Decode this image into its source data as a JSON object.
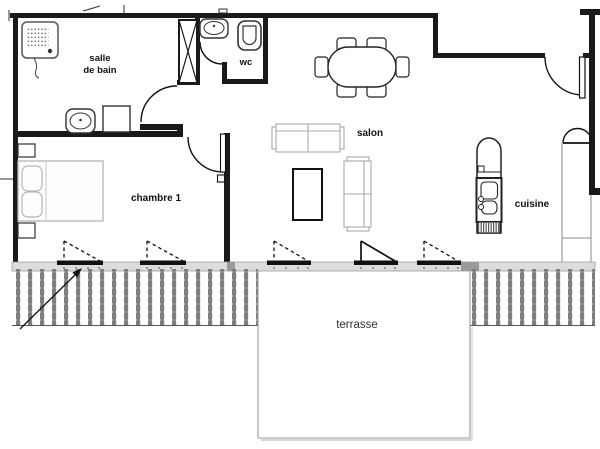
{
  "title": "apartment floor plan",
  "rooms": {
    "bathroom": {
      "line1": "salle",
      "line2": "de bain"
    },
    "wc": {
      "label": "wc"
    },
    "living": {
      "label": "salon"
    },
    "bedroom": {
      "label": "chambre 1"
    },
    "kitchen": {
      "label": "cuisine"
    },
    "terrace": {
      "label": "terrasse"
    }
  },
  "fixtures": [
    "shower",
    "bathroom-sink",
    "washing-machine",
    "duct-column",
    "wc-hand-basin",
    "toilet",
    "bed",
    "nightstand",
    "dining-table",
    "dining-chair",
    "sofa",
    "coffee-table",
    "fridge",
    "kitchen-sink",
    "stove",
    "entrance-door",
    "interior-door",
    "window",
    "terrace-door",
    "terrace-railing",
    "entrance-arrow"
  ],
  "colors": {
    "wall": "#1a1a1a",
    "facade_band": "#dcdcdc",
    "facade_pier": "#9a9a9a",
    "window_sill": "#111111",
    "railing_bar": "#7d7d7d",
    "furniture_gray": "#aaaaaa",
    "thin_line": "#8a8a8a"
  }
}
